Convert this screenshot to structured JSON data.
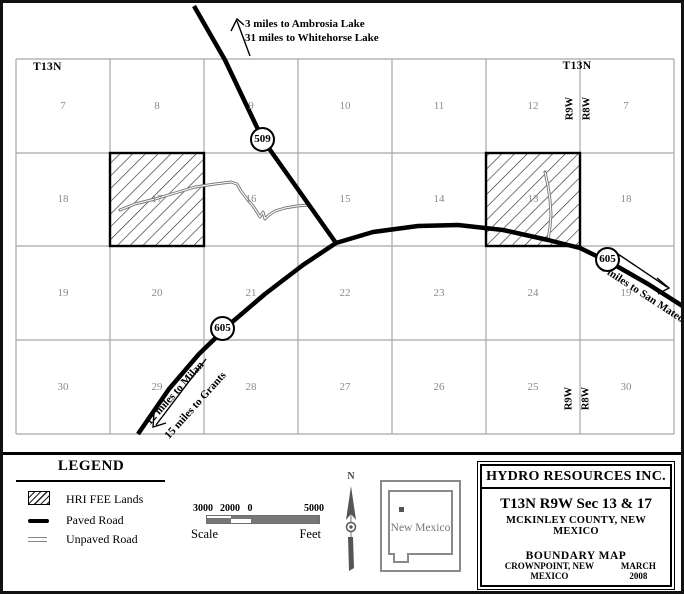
{
  "map": {
    "township_left": "T13N",
    "township_right": "T13N",
    "range9": "R9W",
    "range8": "R8W",
    "routes": {
      "hwy509": "509",
      "hwy605": "605"
    },
    "annotations": {
      "ambrosia_line1": "3 miles to Ambrosia Lake",
      "ambrosia_line2": "31 miles to Whitehorse Lake",
      "san_mateo": "4 miles to San Mateo",
      "milan": "12 miles to Milan",
      "grants": "15 miles to Grants"
    },
    "sections": [
      {
        "label": "7",
        "col": 0,
        "row": 0
      },
      {
        "label": "8",
        "col": 1,
        "row": 0
      },
      {
        "label": "9",
        "col": 2,
        "row": 0
      },
      {
        "label": "10",
        "col": 3,
        "row": 0
      },
      {
        "label": "11",
        "col": 4,
        "row": 0
      },
      {
        "label": "12",
        "col": 5,
        "row": 0
      },
      {
        "label": "7",
        "col": 6,
        "row": 0
      },
      {
        "label": "18",
        "col": 0,
        "row": 1
      },
      {
        "label": "17",
        "col": 1,
        "row": 1
      },
      {
        "label": "16",
        "col": 2,
        "row": 1
      },
      {
        "label": "15",
        "col": 3,
        "row": 1
      },
      {
        "label": "14",
        "col": 4,
        "row": 1
      },
      {
        "label": "13",
        "col": 5,
        "row": 1
      },
      {
        "label": "18",
        "col": 6,
        "row": 1
      },
      {
        "label": "19",
        "col": 0,
        "row": 2
      },
      {
        "label": "20",
        "col": 1,
        "row": 2
      },
      {
        "label": "21",
        "col": 2,
        "row": 2
      },
      {
        "label": "22",
        "col": 3,
        "row": 2
      },
      {
        "label": "23",
        "col": 4,
        "row": 2
      },
      {
        "label": "24",
        "col": 5,
        "row": 2
      },
      {
        "label": "19",
        "col": 6,
        "row": 2
      },
      {
        "label": "30",
        "col": 0,
        "row": 3
      },
      {
        "label": "29",
        "col": 1,
        "row": 3
      },
      {
        "label": "28",
        "col": 2,
        "row": 3
      },
      {
        "label": "27",
        "col": 3,
        "row": 3
      },
      {
        "label": "26",
        "col": 4,
        "row": 3
      },
      {
        "label": "25",
        "col": 5,
        "row": 3
      },
      {
        "label": "30",
        "col": 6,
        "row": 3
      }
    ],
    "hatched_sections": [
      "17",
      "13"
    ]
  },
  "legend": {
    "title": "LEGEND",
    "items": [
      {
        "label": "HRI FEE Lands",
        "swatch": "hatch-swatch"
      },
      {
        "label": "Paved Road",
        "swatch": "paved-road-swatch"
      },
      {
        "label": "Unpaved Road",
        "swatch": "unpaved-road-swatch"
      }
    ],
    "scale": {
      "ticks": [
        "3000",
        "2000",
        "0",
        "5000"
      ],
      "left_label": "Scale",
      "right_label": "Feet"
    }
  },
  "compass": {
    "north_label": "N"
  },
  "inset": {
    "state_label": "New Mexico"
  },
  "title_block": {
    "company": "HYDRO RESOURCES INC.",
    "line1": "T13N R9W Sec 13 & 17",
    "line2": "MCKINLEY COUNTY, NEW MEXICO",
    "line3": "BOUNDARY MAP",
    "footer_left": "CROWNPOINT, NEW MEXICO",
    "footer_right": "MARCH 2008"
  },
  "colors": {
    "paved_road": "#000000",
    "unpaved_road": "#7a7a7a",
    "grid_line": "#a8a8a8",
    "section_number": "#8a8a8a",
    "state_outline": "#8a8a8a"
  }
}
